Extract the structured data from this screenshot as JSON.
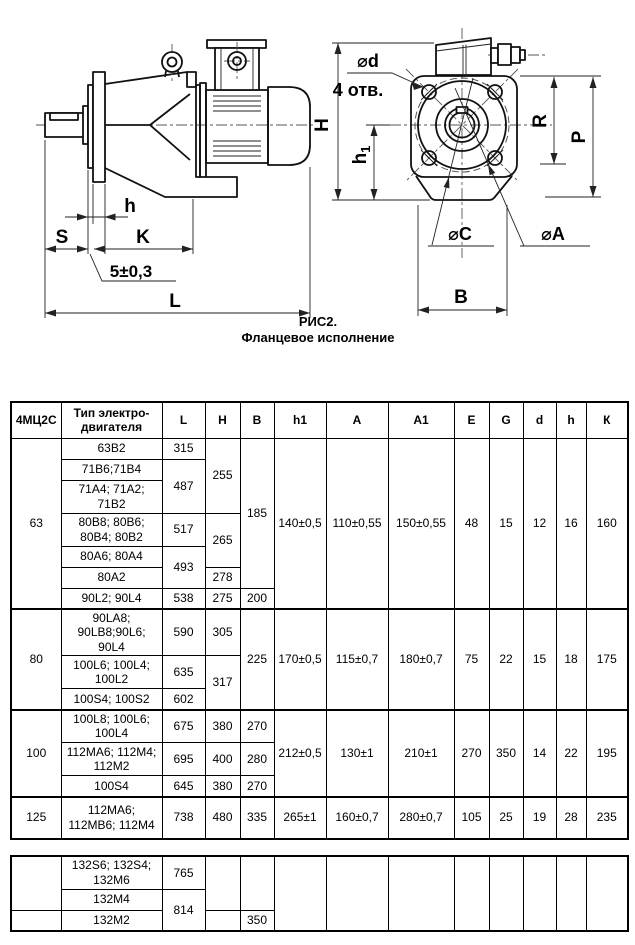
{
  "drawing": {
    "caption1": "РИС2.",
    "caption2": "Фланцевое исполнение",
    "labels": {
      "h": "h",
      "s": "S",
      "k": "K",
      "tol": "5±0,3",
      "l": "L",
      "dia_d": "⌀d",
      "holes": "4 отв.",
      "cap_h": "H",
      "h1_main": "h",
      "h1_sub": "1",
      "r": "R",
      "p": "P",
      "dia_c": "⌀C",
      "dia_a": "⌀A",
      "b": "B"
    }
  },
  "table1": {
    "headers": [
      "4МЦ2С",
      "Тип электро-\nдвигателя",
      "L",
      "H",
      "B",
      "h1",
      "A",
      "A1",
      "E",
      "G",
      "d",
      "h",
      "К"
    ],
    "r1": [
      "63",
      "63В2",
      "315",
      "255",
      "185",
      "140±0,5",
      "110±0,55",
      "150±0,55",
      "48",
      "15",
      "12",
      "16",
      "160"
    ],
    "r2": [
      "71В6;71В4",
      "487"
    ],
    "r3": [
      "71А4; 71А2; 71В2"
    ],
    "r4": [
      "80В8; 80В6; 80В4; 80В2",
      "517",
      "265"
    ],
    "r5": [
      "80А6; 80А4",
      "493"
    ],
    "r6": [
      "80А2",
      "278"
    ],
    "r7": [
      "90L2; 90L4",
      "538",
      "275",
      "200"
    ],
    "r8": [
      "80",
      "90LA8; 90LB8;90L6; 90L4",
      "590",
      "305",
      "225",
      "170±0,5",
      "115±0,7",
      "180±0,7",
      "75",
      "22",
      "15",
      "18",
      "175"
    ],
    "r9": [
      "100L6; 100L4; 100L2",
      "635",
      "317"
    ],
    "r10": [
      "100S4; 100S2",
      "602"
    ],
    "r11": [
      "100",
      "100L8; 100L6; 100L4",
      "675",
      "380",
      "270",
      "212±0,5",
      "130±1",
      "210±1",
      "270",
      "350",
      "14",
      "22",
      "195"
    ],
    "r12": [
      "112МА6; 112М4; 112М2",
      "695",
      "400",
      "280"
    ],
    "r13": [
      "100S4",
      "645",
      "380",
      "270"
    ],
    "r14": [
      "125",
      "112МА6; 112МВ6; 112М4",
      "738",
      "480",
      "335",
      "265±1",
      "160±0,7",
      "280±0,7",
      "105",
      "25",
      "19",
      "28",
      "235"
    ]
  },
  "table2": {
    "r1": [
      "132S6; 132S4; 132М6",
      "765"
    ],
    "r2": [
      "132М4",
      "814"
    ],
    "r3": [
      "132М2",
      "350"
    ]
  }
}
